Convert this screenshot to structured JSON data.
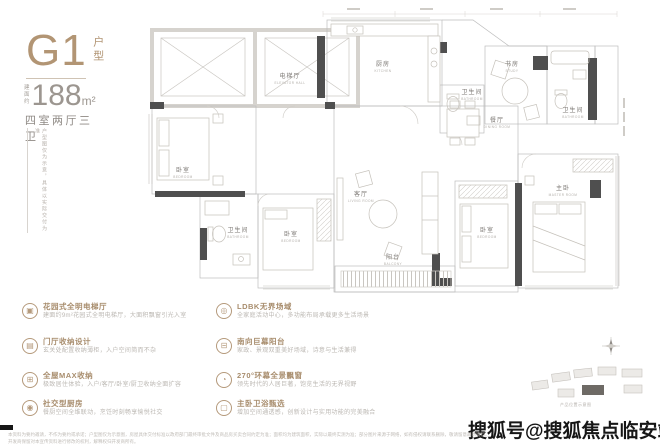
{
  "header": {
    "type_code": "G1",
    "type_suffix": "户型",
    "area_label_1": "建面",
    "area_label_2": "约",
    "area_value": "188",
    "area_unit": "m²",
    "rooms_text": "四室两厅三卫",
    "vertical_note": "户型图仅为示意，具体以实际交付为准"
  },
  "plan": {
    "rooms": [
      {
        "cn": "电梯厅",
        "en": "ELEVATOR HALL"
      },
      {
        "cn": "厨房",
        "en": "KITCHEN"
      },
      {
        "cn": "餐厅",
        "en": "DINING ROOM"
      },
      {
        "cn": "卫生间",
        "en": "BATHROOM"
      },
      {
        "cn": "书房",
        "en": "STUDY"
      },
      {
        "cn": "卫生间",
        "en": "BATHROOM"
      },
      {
        "cn": "卧室",
        "en": "BEDROOM"
      },
      {
        "cn": "卫生间",
        "en": "BATHROOM"
      },
      {
        "cn": "卧室",
        "en": "BEDROOM"
      },
      {
        "cn": "客厅",
        "en": "LIVING ROOM"
      },
      {
        "cn": "卧室",
        "en": "BEDROOM"
      },
      {
        "cn": "主卧",
        "en": "MASTER ROOM"
      },
      {
        "cn": "阳台",
        "en": "BALCONY"
      }
    ]
  },
  "features": {
    "left": [
      {
        "icon": "elevator-hall-icon",
        "glyph": "▣",
        "title": "花园式全明电梯厅",
        "desc": "建面约9m²花园式全明电梯厅，大面积飘窗引光入室"
      },
      {
        "icon": "foyer-storage-icon",
        "glyph": "▤",
        "title": "门厅收纳设计",
        "desc": "玄关处配置收纳薄柜，入户空间简而不杂"
      },
      {
        "icon": "max-storage-icon",
        "glyph": "⊞",
        "title": "全屋MAX收纳",
        "desc": "极致居住体验，入户/客厅/卧室/厨卫收纳全面扩容"
      },
      {
        "icon": "social-kitchen-icon",
        "glyph": "◉",
        "title": "社交型厨房",
        "desc": "餐厨空间全维联动，烹饪时刻畅享愉悦社交"
      }
    ],
    "right": [
      {
        "icon": "ldbk-space-icon",
        "glyph": "◎",
        "title": "LDBK无界场域",
        "desc": "全家庭活动中心，多功能布局承载更多生活场景"
      },
      {
        "icon": "south-balcony-icon",
        "glyph": "⊟",
        "title": "南向巨幕阳台",
        "desc": "家政、景观双重美好场域，诗意与生活兼得"
      },
      {
        "icon": "bay-window-icon",
        "glyph": "◔",
        "title": "270°环幕全景飘窗",
        "desc": "领先时代的人居巨著，饱览生活的无界视野"
      },
      {
        "icon": "master-bath-icon",
        "glyph": "▢",
        "title": "主卧卫浴甄选",
        "desc": "增加空间通透感，创新设计与实用功能的完美融合"
      }
    ]
  },
  "site": {
    "caption": "产品位置示意图"
  },
  "watermark": {
    "text": "搜狐号@搜狐焦点临安站"
  },
  "disclaimer": {
    "line1": "本资料为要约邀请，不作为要约或承诺；户型图仅为示意图，房屋具体交付标准以政府部门最终审批文件及商品房买卖合同约定为准；面积均为建筑面积，实际以最终实测为准；部分图片来源于网络，如有侵权请联系删除，敬请留意最新资料。",
    "line2": "开发商保留对本宣传资料进行修改的权利，解释权归开发商所有。"
  },
  "colors": {
    "accent": "#b29574",
    "wall": "#4f4f4f",
    "line": "#bdbdbd"
  }
}
